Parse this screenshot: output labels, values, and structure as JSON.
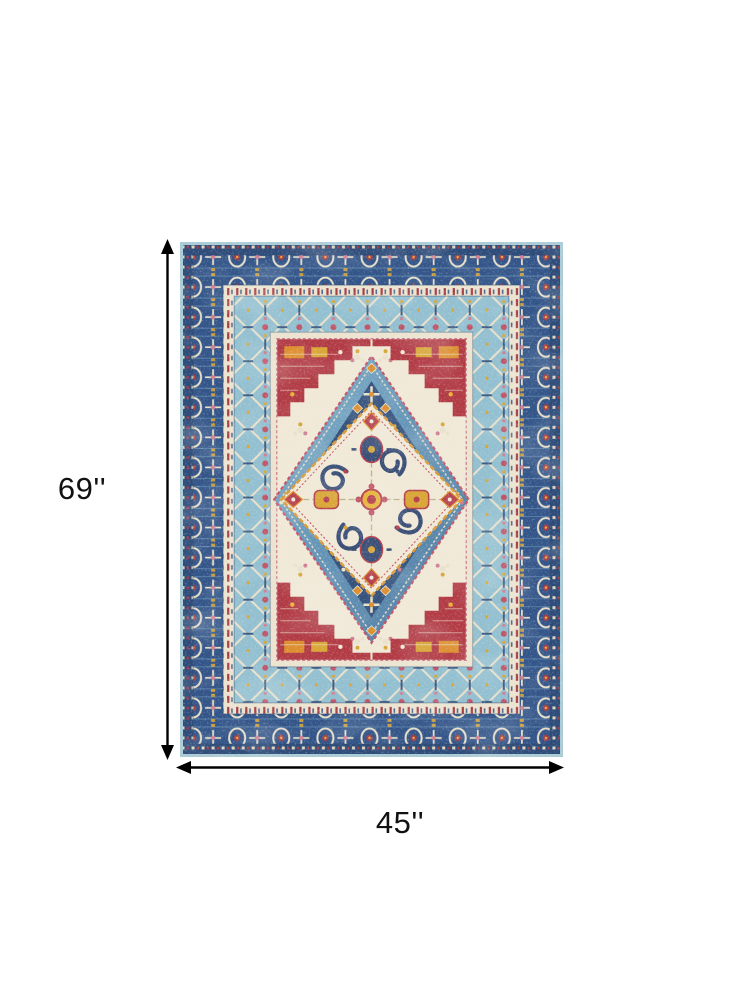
{
  "annotations": {
    "height": {
      "label": "69''"
    },
    "width": {
      "label": "45''"
    },
    "arrow_color": "#000000",
    "text_color": "#111111"
  },
  "rug": {
    "style": "distressed traditional heriz medallion area rug",
    "palette": {
      "navy": "#335589",
      "dark_navy": "#2e4c7a",
      "denim_blue": "#6495b8",
      "light_blue": "#93c0d1",
      "pale_blue_edge": "#a9cbd6",
      "cream": "#f1e9d7",
      "guard_cream": "#ece4d0",
      "crimson": "#b23c46",
      "red_pink": "#c05568",
      "orange": "#dd8e2e",
      "gold": "#d9a637",
      "olive": "#b0a97f",
      "pink": "#cf7f93"
    }
  }
}
